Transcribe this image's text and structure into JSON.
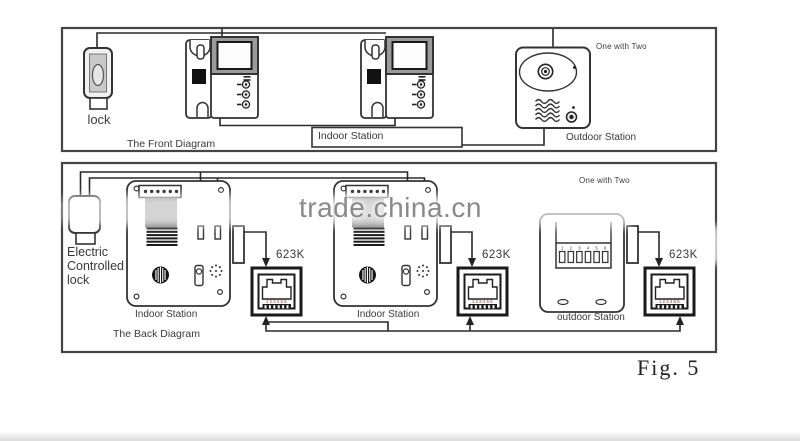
{
  "figure": {
    "caption": "Fig. 5"
  },
  "watermark": {
    "text": "trade.china.cn",
    "color": "#8a8a8a"
  },
  "front_diagram": {
    "caption": "The Front Diagram",
    "lock_label": "lock",
    "indoor_station_label": "Indoor Station",
    "outdoor_station_label": "Outdoor Station",
    "one_with_two": "One with Two"
  },
  "back_diagram": {
    "caption": "The Back Diagram",
    "lock_label": "Electric Controlled lock",
    "indoor_station_labels": [
      "Indoor Station",
      "Indoor Station"
    ],
    "outdoor_station_label": "outdoor Station",
    "one_with_two": "One with Two",
    "connector_labels": [
      "623K",
      "623K",
      "623K"
    ],
    "dip_numbers": [
      "1",
      "2",
      "3",
      "4",
      "5",
      "6"
    ],
    "jack_pin_numbers": "123456"
  },
  "colors": {
    "line": "#333333",
    "monitor_bezel": "#9a9a9a",
    "heatsink_block": "#7a7a7a",
    "jack_pin_text": "#a03828",
    "watermark": "#8a8a8a"
  }
}
